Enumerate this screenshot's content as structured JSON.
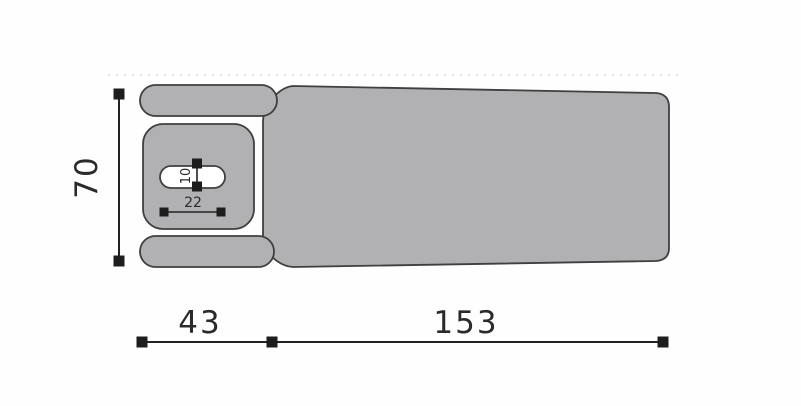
{
  "diagram": {
    "type": "technical-dimension-drawing",
    "subject": "table-top-view",
    "colors": {
      "part_fill": "#b1b1b3",
      "part_outline": "#3f3f3f",
      "dimension_line": "#222222",
      "dimension_text": "#2a2a2a",
      "hole_fill": "#ffffff",
      "background": "#fefefe",
      "dotted_guide": "#e4e4e4"
    },
    "dimensions": {
      "total_height": {
        "label": "70",
        "orientation": "vertical"
      },
      "head_section_width": {
        "label": "43",
        "orientation": "horizontal"
      },
      "main_body_width": {
        "label": "153",
        "orientation": "horizontal"
      },
      "face_hole_height": {
        "label": "10",
        "orientation": "vertical"
      },
      "face_hole_width": {
        "label": "22",
        "orientation": "horizontal"
      }
    }
  }
}
